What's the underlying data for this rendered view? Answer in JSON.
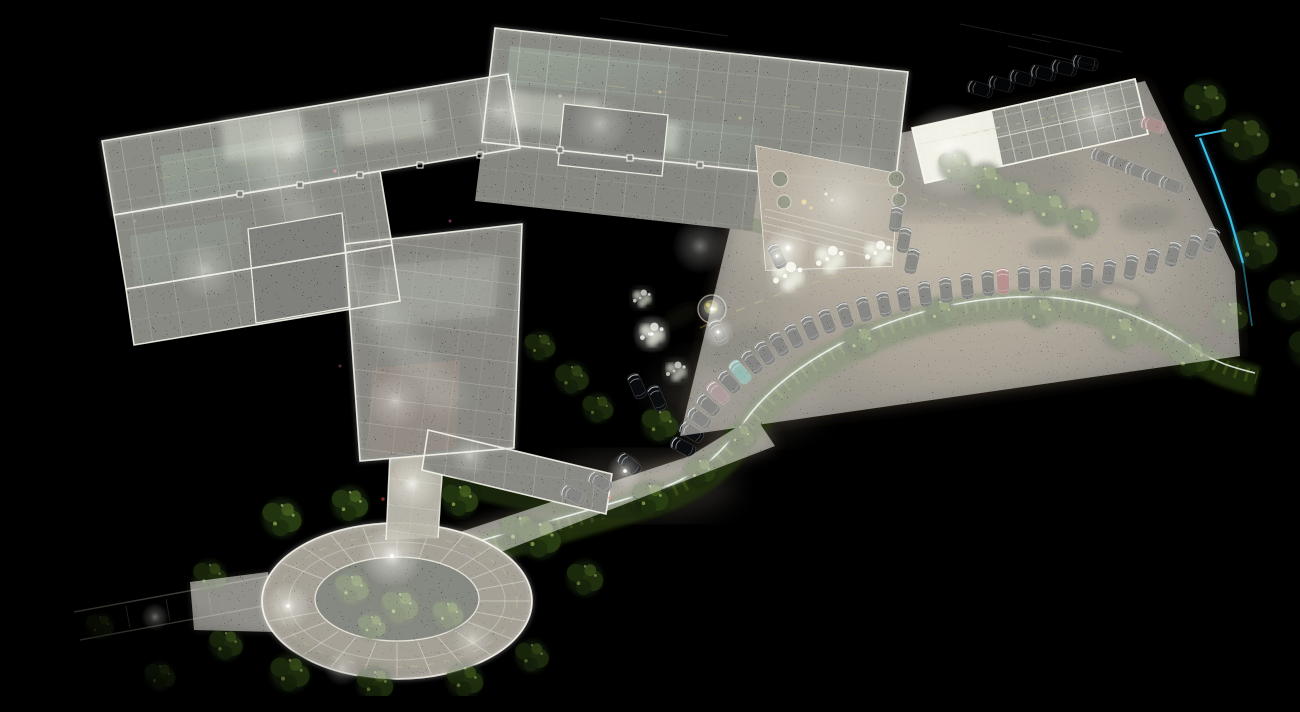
{
  "scene": {
    "description": "Top-down orthographic night view of a LiDAR point-cloud scan: a multi-wing apartment building with glowing interior walls at upper left, a white-framed parking canopy and tan parking field with a curved row of parked cars at right, an S-curved hedge with white curb, a landscaped plaza with planters, white-lit trees, a horseshoe paver driveway with a tree island at lower left, and a cyan scan clipping line near the right edge, all on a black background.",
    "view": "top-down orthographic point cloud",
    "regions": {
      "building_complex": "multi-wing building floor-plan point cloud",
      "parking_canopy": "white-framed carport canopy",
      "parking_lot": "tan parking field with swirl patterns",
      "car_row_arc": "curved row of parked cars",
      "hedge_curve": "S-curved hedge with white curb line",
      "plaza": "courtyard plaza with planters and steps",
      "loop_driveway": "horseshoe paver driveway with center tree island",
      "tree_belt": "dark tree canopies along right edge",
      "clip_boundary": "cyan scan clipping line"
    },
    "colors": {
      "background": "#000000",
      "wall_line_white": "#f2f0e6",
      "interior_glass_green": "#31432f",
      "ground_tan": "#6a5a46",
      "hedge_green": "#2c3a12",
      "tree_lit_green": "#66802f",
      "white_tree": "#e4ead9",
      "light_glow": "#ffffff",
      "clip_line_cyan": "#3fc6ee",
      "marking_yellow": "#8f7c2e",
      "car_body_dark": "#0a0c10",
      "car_red": "#6e2225",
      "car_teal": "#2c7d74",
      "car_maroon": "#5e3840"
    }
  }
}
